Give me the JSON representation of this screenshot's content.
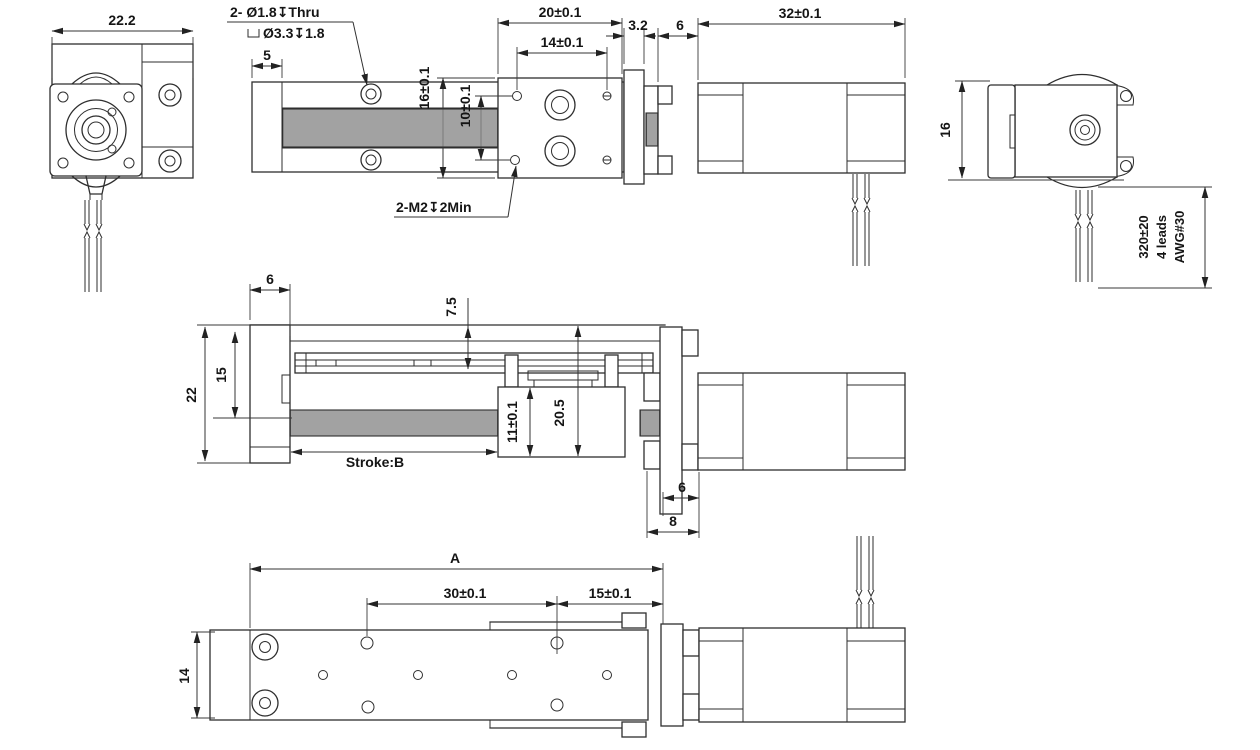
{
  "colors": {
    "background": "#ffffff",
    "line": "#2e2e2e",
    "dim_text": "#151515"
  },
  "front_view": {
    "width_dim": "22.2"
  },
  "plan_view": {
    "hole_callout_line1": "2- Ø1.8↧Thru",
    "hole_callout_line2": "Ø3.3↧1.8",
    "end_plate_dim": "5",
    "carriage_length_dim": "20±0.1",
    "carriage_hole_span_dim": "14±0.1",
    "adapter_plate_dim": "3.2",
    "coupling_gap_dim": "6",
    "motor_length_dim": "32±0.1",
    "carriage_width_dim": "16±0.1",
    "hole_row_span_dim": "10±0.1",
    "tap_callout": "2-M2↧2Min"
  },
  "motor_end_view": {
    "height_dim": "16",
    "lead_length_dim": "320±20",
    "lead_count_label": "4 leads",
    "lead_gauge_label": "AWG#30"
  },
  "side_view": {
    "end_plate_dim": "6",
    "rail_height_dim": "7.5",
    "guide_height_dim": "15",
    "overall_height_dim": "22",
    "stroke_label": "Stroke:B",
    "nut_height_dim": "11±0.1",
    "block_height_dim": "20.5",
    "flange_gap_dim": "6",
    "bracket_depth_dim": "8"
  },
  "bottom_view": {
    "overall_length_dim": "A",
    "hole_span_dim": "30±0.1",
    "hole_end_dim": "15±0.1",
    "width_dim": "14"
  }
}
